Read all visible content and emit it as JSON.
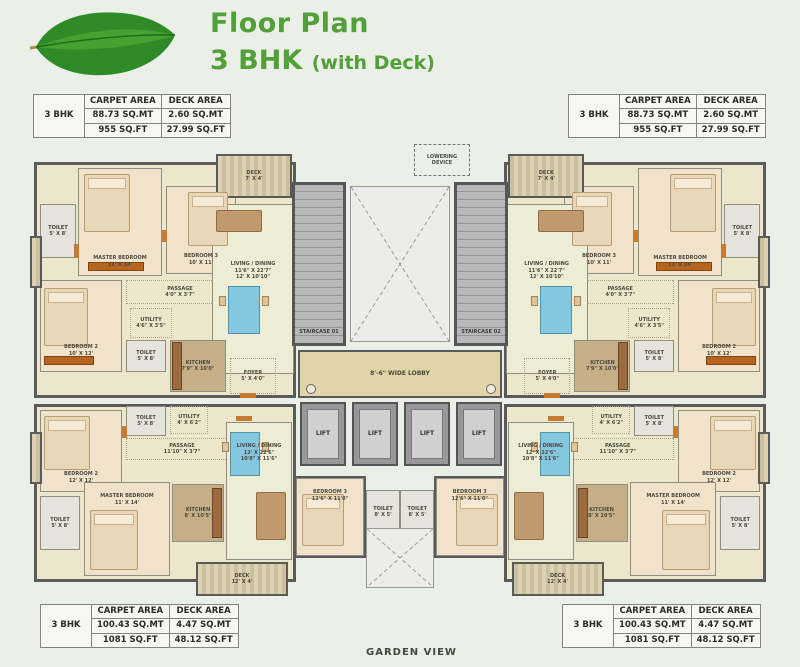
{
  "header": {
    "title_line1": "Floor Plan",
    "title_line2_main": "3 BHK",
    "title_line2_suffix": "(with Deck)"
  },
  "footer": {
    "garden_view": "GARDEN VIEW"
  },
  "colors": {
    "title_green": "#53a03a",
    "wall_gray": "#5a5a5a",
    "floor_cream": "#ece7cb",
    "bedroom_peach": "#f1e2cc",
    "lobby_tan": "#e0d5a7",
    "table_blue": "#84c7de",
    "accent_orange": "#b5651d"
  },
  "tables": {
    "top_left": {
      "unit": "3 BHK",
      "carpet_header": "CARPET AREA",
      "deck_header": "DECK AREA",
      "carpet_mt": "88.73 SQ.MT",
      "carpet_ft": "955 SQ.FT",
      "deck_mt": "2.60 SQ.MT",
      "deck_ft": "27.99 SQ.FT"
    },
    "top_right": {
      "unit": "3 BHK",
      "carpet_header": "CARPET AREA",
      "deck_header": "DECK AREA",
      "carpet_mt": "88.73 SQ.MT",
      "carpet_ft": "955 SQ.FT",
      "deck_mt": "2.60 SQ.MT",
      "deck_ft": "27.99 SQ.FT"
    },
    "bottom_left": {
      "unit": "3 BHK",
      "carpet_header": "CARPET AREA",
      "deck_header": "DECK AREA",
      "carpet_mt": "100.43 SQ.MT",
      "carpet_ft": "1081 SQ.FT",
      "deck_mt": "4.47 SQ.MT",
      "deck_ft": "48.12 SQ.FT"
    },
    "bottom_right": {
      "unit": "3 BHK",
      "carpet_header": "CARPET AREA",
      "deck_header": "DECK AREA",
      "carpet_mt": "100.43 SQ.MT",
      "carpet_ft": "1081 SQ.FT",
      "deck_mt": "4.47 SQ.MT",
      "deck_ft": "48.12 SQ.FT"
    }
  },
  "plan": {
    "lowering_device": "LOWERING\nDEVICE",
    "staircase_01": "STAIRCASE 01",
    "staircase_02": "STAIRCASE 02",
    "lobby_label": "8'-6\" WIDE LOBBY",
    "lift_label": "LIFT",
    "top_apartment": {
      "deck": "DECK\n7' X 4'",
      "toilet_1": "TOILET\n5' X 8'",
      "master_bedroom": "MASTER BEDROOM\n11' X 14'",
      "bedroom_3": "BEDROOM 3\n10' X 11'",
      "bedroom_2": "BEDROOM 2\n10' X 12'",
      "passage": "PASSAGE\n4'0\" X 3'7\"",
      "living_dining": "LIVING / DINING\n11'6\" X 22'7\"\n12' X 10'10\"",
      "utility": "UTILITY\n4'6\" X 3'5\"",
      "toilet_2": "TOILET\n5' X 8'",
      "kitchen": "KITCHEN\n7'9\" X 10'0\"",
      "foyer": "FOYER\n5' X 4'0\""
    },
    "bottom_apartment": {
      "bedroom_2": "BEDROOM 2\n12' X 12'",
      "toilet_1": "TOILET\n5' X 8'",
      "utility": "UTILITY\n4' X 6'2\"",
      "passage": "PASSAGE\n11'10\" X 3'7\"",
      "master_bedroom": "MASTER BEDROOM\n11' X 14'",
      "toilet_2": "TOILET\n5' X 8'",
      "kitchen": "KITCHEN\n8' X 10'5\"",
      "living_dining": "LIVING / DINING\n12' X 22'6\"\n10'8\" X 11'6\"",
      "bedroom_3": "BEDROOM 3\n12'6\" X 11'0\"",
      "toilet_3": "TOILET\n8' X 5'",
      "deck": "DECK\n12' X 4'"
    }
  }
}
